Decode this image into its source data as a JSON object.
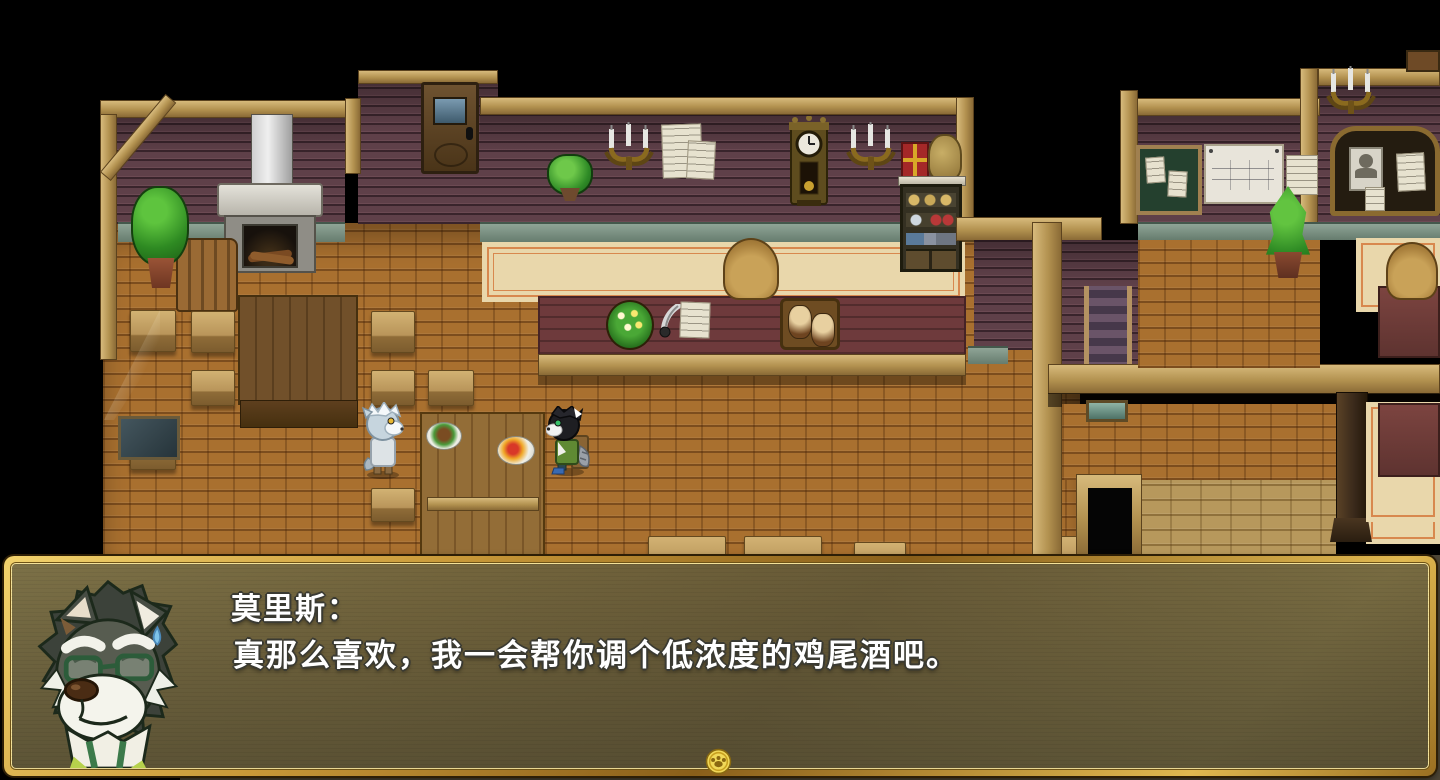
{
  "scene": {
    "type": "rpg-tavern-interior",
    "npcs": [
      "white-wolf-patron",
      "black-wolf-patron-seated"
    ],
    "portrait": "gray-wolf-bartender-with-green-glasses"
  },
  "dialogue": {
    "speaker": "莫里斯：",
    "text": "真那么喜欢，我一会帮你调个低浓度的鸡尾酒吧。"
  },
  "hud": {
    "continue_icon": "gold-paw-coin"
  },
  "colors": {
    "frame_gold": "#c9973b",
    "dialog_fill": "rgba(88,82,58,0.85)",
    "dialog_text": "#ffffff",
    "floor_brick": "#a9702f",
    "wall_panel": "#5f4049",
    "wood_beam": "#c9a86a",
    "bar_counter": "#6e3a3c",
    "carpet": "#e9d7ab"
  }
}
